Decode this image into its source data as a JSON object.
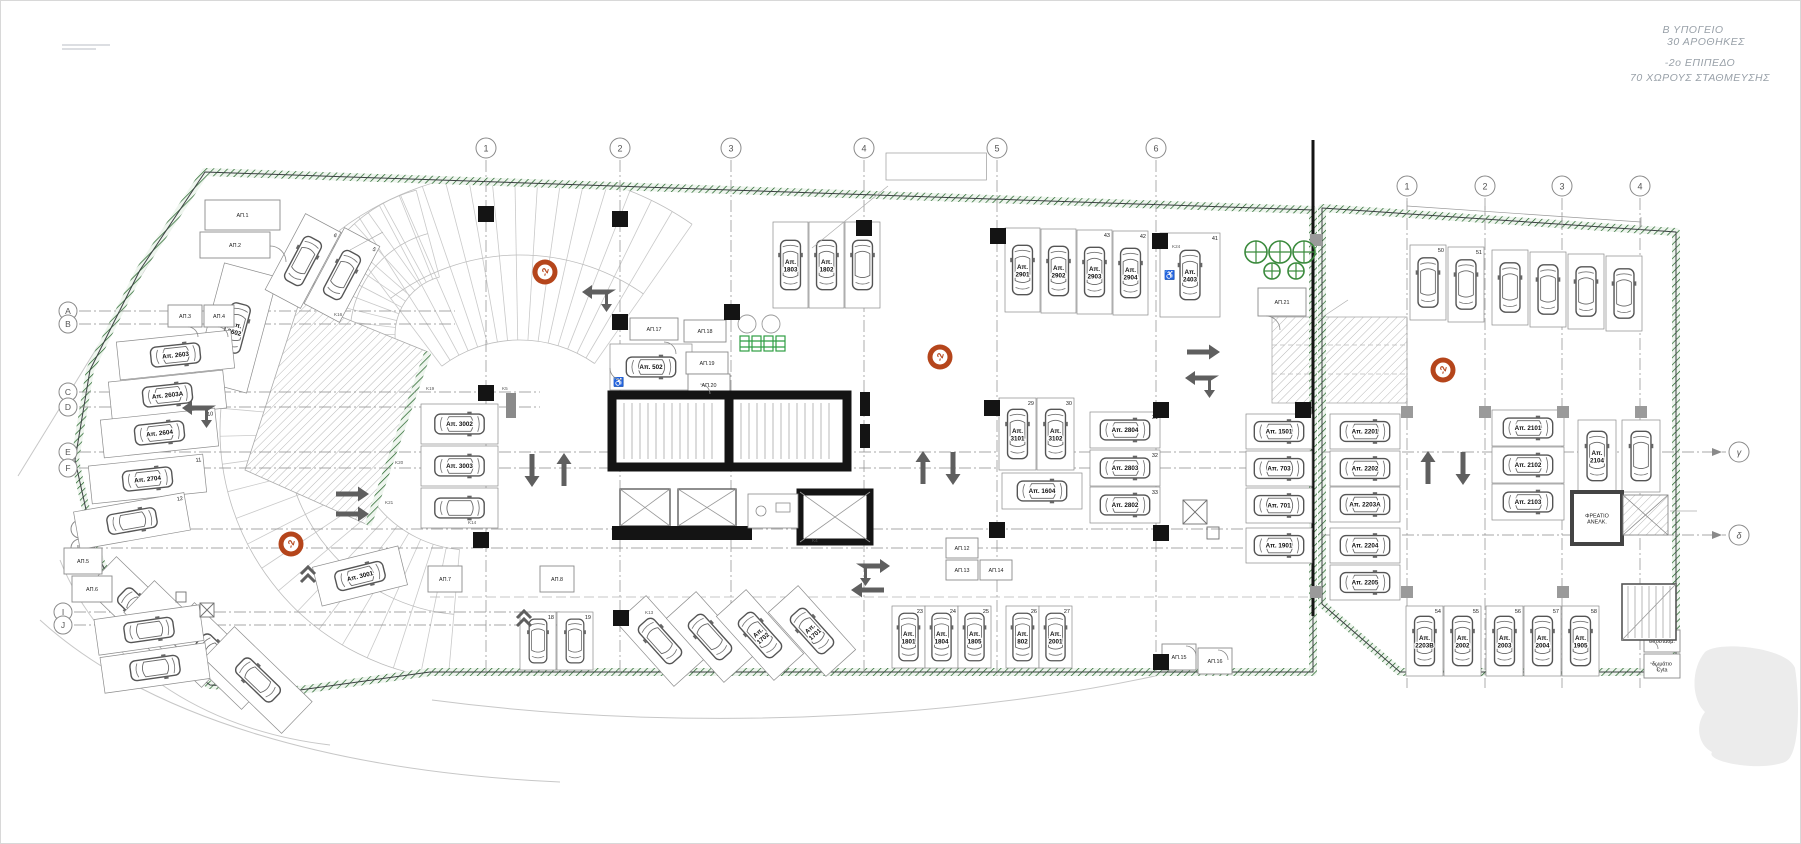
{
  "title_block": {
    "lines": [
      "Β ΥΠΟΓΕΙΟ",
      "30 ΑΡΟΘΗΚΕΣ",
      "-2ο ΕΠΙΠΕΔΟ",
      "70 ΧΩΡΟΥΣ ΣΤΑΘΜΕΥΣΗΣ"
    ]
  },
  "level_badge_label": "-2",
  "colors": {
    "boundary_green": "#2e7d32",
    "badge_orange": "#b5451b",
    "wall_black": "#141414",
    "arrow_gray": "#5f5f5f",
    "annotation_gray": "#9aa1a8",
    "bracket_orange": "#c8802f"
  },
  "grid": {
    "main_cols": [
      {
        "label": "1",
        "x": 486
      },
      {
        "label": "2",
        "x": 620
      },
      {
        "label": "3",
        "x": 731
      },
      {
        "label": "4",
        "x": 864
      },
      {
        "label": "5",
        "x": 997
      },
      {
        "label": "6",
        "x": 1156
      }
    ],
    "annex_cols": [
      {
        "label": "1",
        "x": 1407
      },
      {
        "label": "2",
        "x": 1485
      },
      {
        "label": "3",
        "x": 1562
      },
      {
        "label": "4",
        "x": 1640
      }
    ],
    "rows": [
      {
        "label": "A",
        "bx": 68,
        "y": 311,
        "x2": 455
      },
      {
        "label": "B",
        "bx": 68,
        "y": 324,
        "x2": 455
      },
      {
        "label": "C",
        "bx": 68,
        "y": 392,
        "x2": 540
      },
      {
        "label": "D",
        "bx": 68,
        "y": 407,
        "x2": 540
      },
      {
        "label": "E",
        "bx": 68,
        "y": 452,
        "x2": 1313
      },
      {
        "label": "F",
        "bx": 68,
        "y": 468,
        "x2": 1313
      },
      {
        "label": "G",
        "bx": 80,
        "y": 529,
        "x2": 1313
      },
      {
        "label": "H",
        "bx": 80,
        "y": 548,
        "x2": 1313
      },
      {
        "label": "I",
        "bx": 63,
        "y": 612,
        "x2": 560
      },
      {
        "label": "J",
        "bx": 63,
        "y": 625,
        "x2": 560
      }
    ],
    "annex_rows": [
      {
        "label": "γ",
        "y": 452
      },
      {
        "label": "δ",
        "y": 535
      }
    ]
  },
  "badges": [
    {
      "x": 545,
      "y": 272
    },
    {
      "x": 291,
      "y": 544
    },
    {
      "x": 940,
      "y": 357
    },
    {
      "x": 1443,
      "y": 370
    }
  ],
  "vents": [
    {
      "x": 1256,
      "y": 252,
      "r": 11
    },
    {
      "x": 1280,
      "y": 252,
      "r": 11
    },
    {
      "x": 1304,
      "y": 252,
      "r": 11
    },
    {
      "x": 1272,
      "y": 271,
      "r": 8
    },
    {
      "x": 1296,
      "y": 271,
      "r": 8
    }
  ],
  "stalls": [
    {
      "label": "Απ. 2602",
      "num": "7",
      "x": 208,
      "y": 268,
      "w": 55,
      "h": 120,
      "rot": 15
    },
    {
      "label": "",
      "num": "6",
      "x": 283,
      "y": 218,
      "w": 40,
      "h": 86,
      "rot": 28
    },
    {
      "label": "",
      "num": "5",
      "x": 322,
      "y": 232,
      "w": 40,
      "h": 86,
      "rot": 28
    },
    {
      "label": "Απ. 2603",
      "x": 118,
      "y": 336,
      "w": 115,
      "h": 38,
      "rot": -6
    },
    {
      "label": "Απ. 2603Α",
      "x": 110,
      "y": 376,
      "w": 115,
      "h": 38,
      "rot": -6
    },
    {
      "label": "Απ. 2604",
      "num": "10",
      "x": 102,
      "y": 414,
      "w": 115,
      "h": 38,
      "rot": -6
    },
    {
      "label": "Απ. 2704",
      "num": "11",
      "x": 90,
      "y": 460,
      "w": 115,
      "h": 38,
      "rot": -6
    },
    {
      "label": "",
      "num": "12",
      "x": 76,
      "y": 502,
      "w": 112,
      "h": 38,
      "rot": -10
    },
    {
      "label": "Απ. 301",
      "x": 118,
      "y": 556,
      "w": 44,
      "h": 108,
      "rot": -46
    },
    {
      "label": "Απ. 801",
      "x": 156,
      "y": 580,
      "w": 44,
      "h": 108,
      "rot": -46
    },
    {
      "label": "",
      "x": 196,
      "y": 602,
      "w": 44,
      "h": 108,
      "rot": -46
    },
    {
      "label": "",
      "x": 236,
      "y": 626,
      "w": 44,
      "h": 108,
      "rot": -46
    },
    {
      "label": "",
      "x": 96,
      "y": 612,
      "w": 106,
      "h": 36,
      "rot": -8
    },
    {
      "label": "",
      "x": 102,
      "y": 650,
      "w": 106,
      "h": 36,
      "rot": -8
    },
    {
      "label": "Απ. 3001",
      "x": 316,
      "y": 556,
      "w": 88,
      "h": 40,
      "rot": -14
    },
    {
      "label": "Απ. 3002",
      "x": 421,
      "y": 404,
      "w": 77,
      "h": 40
    },
    {
      "label": "Απ. 3003",
      "x": 421,
      "y": 446,
      "w": 77,
      "h": 40
    },
    {
      "label": "",
      "x": 421,
      "y": 488,
      "w": 77,
      "h": 40
    },
    {
      "label": "Απ. 502",
      "x": 610,
      "y": 344,
      "w": 82,
      "h": 46,
      "dis": true
    },
    {
      "label": "Απ. 1803",
      "x": 773,
      "y": 222,
      "w": 35,
      "h": 86
    },
    {
      "label": "Απ. 1802",
      "x": 809,
      "y": 222,
      "w": 35,
      "h": 86
    },
    {
      "label": "",
      "x": 845,
      "y": 222,
      "w": 35,
      "h": 86
    },
    {
      "label": "Απ. 2901",
      "x": 1005,
      "y": 228,
      "w": 35,
      "h": 84
    },
    {
      "label": "Απ. 2902",
      "x": 1041,
      "y": 229,
      "w": 35,
      "h": 84
    },
    {
      "label": "Απ. 2903",
      "num": "43",
      "x": 1077,
      "y": 230,
      "w": 35,
      "h": 84
    },
    {
      "label": "Απ. 2904",
      "num": "42",
      "x": 1113,
      "y": 231,
      "w": 35,
      "h": 84
    },
    {
      "label": "Απ. 2403",
      "num": "41",
      "x": 1160,
      "y": 233,
      "w": 60,
      "h": 84,
      "dis": true
    },
    {
      "label": "Απ. 3101",
      "num": "29",
      "x": 999,
      "y": 398,
      "w": 37,
      "h": 72
    },
    {
      "label": "Απ. 3102",
      "num": "30",
      "x": 1037,
      "y": 398,
      "w": 37,
      "h": 72
    },
    {
      "label": "Απ. 1604",
      "x": 1002,
      "y": 473,
      "w": 80,
      "h": 36
    },
    {
      "label": "Απ. 2804",
      "num": "31",
      "x": 1090,
      "y": 412,
      "w": 70,
      "h": 36
    },
    {
      "label": "Απ. 2803",
      "num": "32",
      "x": 1090,
      "y": 450,
      "w": 70,
      "h": 36
    },
    {
      "label": "Απ. 2802",
      "num": "33",
      "x": 1090,
      "y": 487,
      "w": 70,
      "h": 36
    },
    {
      "label": "Απ. 1501",
      "x": 1246,
      "y": 414,
      "w": 66,
      "h": 35
    },
    {
      "label": "Απ. 703",
      "x": 1246,
      "y": 451,
      "w": 66,
      "h": 35
    },
    {
      "label": "Απ. 701",
      "x": 1246,
      "y": 488,
      "w": 66,
      "h": 35
    },
    {
      "label": "Απ. 1901",
      "x": 1246,
      "y": 528,
      "w": 66,
      "h": 35
    },
    {
      "label": "",
      "num": "18",
      "x": 520,
      "y": 612,
      "w": 36,
      "h": 58
    },
    {
      "label": "",
      "num": "19",
      "x": 557,
      "y": 612,
      "w": 36,
      "h": 58
    },
    {
      "label": "",
      "x": 640,
      "y": 598,
      "w": 40,
      "h": 86,
      "rot": -42
    },
    {
      "label": "",
      "x": 690,
      "y": 594,
      "w": 40,
      "h": 86,
      "rot": -42
    },
    {
      "label": "Απ. 1702",
      "x": 740,
      "y": 592,
      "w": 40,
      "h": 86,
      "rot": -42
    },
    {
      "label": "Απ. 1701",
      "x": 792,
      "y": 588,
      "w": 40,
      "h": 86,
      "rot": -42
    },
    {
      "label": "Απ. 1801",
      "num": "23",
      "x": 892,
      "y": 606,
      "w": 33,
      "h": 62
    },
    {
      "label": "Απ. 1804",
      "num": "24",
      "x": 925,
      "y": 606,
      "w": 33,
      "h": 62
    },
    {
      "label": "Απ. 1805",
      "num": "25",
      "x": 958,
      "y": 606,
      "w": 33,
      "h": 62
    },
    {
      "label": "Απ. 802",
      "num": "26",
      "x": 1006,
      "y": 606,
      "w": 33,
      "h": 62
    },
    {
      "label": "Απ. 2001",
      "num": "27",
      "x": 1039,
      "y": 606,
      "w": 33,
      "h": 62
    },
    {
      "label": "",
      "num": "50",
      "x": 1410,
      "y": 245,
      "w": 36,
      "h": 75
    },
    {
      "label": "",
      "num": "51",
      "x": 1448,
      "y": 247,
      "w": 36,
      "h": 75
    },
    {
      "label": "",
      "x": 1492,
      "y": 250,
      "w": 36,
      "h": 75
    },
    {
      "label": "",
      "x": 1530,
      "y": 252,
      "w": 36,
      "h": 75
    },
    {
      "label": "",
      "x": 1568,
      "y": 254,
      "w": 36,
      "h": 75
    },
    {
      "label": "",
      "x": 1606,
      "y": 256,
      "w": 36,
      "h": 75
    },
    {
      "label": "Απ. 2201",
      "x": 1330,
      "y": 414,
      "w": 70,
      "h": 35
    },
    {
      "label": "Απ. 2202",
      "x": 1330,
      "y": 451,
      "w": 70,
      "h": 35
    },
    {
      "label": "Απ. 2203Α",
      "x": 1330,
      "y": 487,
      "w": 70,
      "h": 35
    },
    {
      "label": "Απ. 2204",
      "x": 1330,
      "y": 528,
      "w": 70,
      "h": 35
    },
    {
      "label": "Απ. 2205",
      "x": 1330,
      "y": 565,
      "w": 70,
      "h": 35
    },
    {
      "label": "Απ. 2101",
      "x": 1492,
      "y": 410,
      "w": 72,
      "h": 36
    },
    {
      "label": "Απ. 2102",
      "x": 1492,
      "y": 447,
      "w": 72,
      "h": 36
    },
    {
      "label": "Απ. 2103",
      "x": 1492,
      "y": 484,
      "w": 72,
      "h": 36
    },
    {
      "label": "Απ. 2104",
      "x": 1578,
      "y": 420,
      "w": 38,
      "h": 72
    },
    {
      "label": "",
      "x": 1622,
      "y": 420,
      "w": 38,
      "h": 72
    },
    {
      "label": "Απ. 2203Β",
      "num": "54",
      "x": 1406,
      "y": 606,
      "w": 37,
      "h": 70
    },
    {
      "label": "Απ. 2002",
      "num": "55",
      "x": 1444,
      "y": 606,
      "w": 37,
      "h": 70
    },
    {
      "label": "Απ. 2003",
      "num": "56",
      "x": 1486,
      "y": 606,
      "w": 37,
      "h": 70
    },
    {
      "label": "Απ. 2004",
      "num": "57",
      "x": 1524,
      "y": 606,
      "w": 37,
      "h": 70
    },
    {
      "label": "Απ. 1905",
      "num": "58",
      "x": 1562,
      "y": 606,
      "w": 37,
      "h": 70
    }
  ],
  "rooms": [
    {
      "label": "ΑΠ.1",
      "x": 205,
      "y": 200,
      "w": 75,
      "h": 30
    },
    {
      "label": "ΑΠ.2",
      "x": 200,
      "y": 232,
      "w": 70,
      "h": 26
    },
    {
      "label": "ΑΠ.3",
      "x": 168,
      "y": 305,
      "w": 34,
      "h": 22
    },
    {
      "label": "ΑΠ.4",
      "x": 204,
      "y": 305,
      "w": 30,
      "h": 22
    },
    {
      "label": "ΑΠ.5",
      "x": 64,
      "y": 548,
      "w": 38,
      "h": 26
    },
    {
      "label": "ΑΠ.6",
      "x": 72,
      "y": 576,
      "w": 40,
      "h": 26
    },
    {
      "label": "ΑΠ.7",
      "x": 428,
      "y": 566,
      "w": 34,
      "h": 26
    },
    {
      "label": "ΑΠ.8",
      "x": 540,
      "y": 566,
      "w": 34,
      "h": 26
    },
    {
      "label": "ΑΠ.12",
      "x": 946,
      "y": 538,
      "w": 32,
      "h": 20
    },
    {
      "label": "ΑΠ.13",
      "x": 946,
      "y": 560,
      "w": 32,
      "h": 20
    },
    {
      "label": "ΑΠ.14",
      "x": 980,
      "y": 560,
      "w": 32,
      "h": 20
    },
    {
      "label": "ΑΠ.15",
      "x": 1162,
      "y": 644,
      "w": 34,
      "h": 26
    },
    {
      "label": "ΑΠ.16",
      "x": 1198,
      "y": 648,
      "w": 34,
      "h": 26
    },
    {
      "label": "ΑΠ.17",
      "x": 630,
      "y": 318,
      "w": 48,
      "h": 22
    },
    {
      "label": "ΑΠ.18",
      "x": 684,
      "y": 320,
      "w": 42,
      "h": 22
    },
    {
      "label": "ΑΠ.19",
      "x": 686,
      "y": 352,
      "w": 42,
      "h": 22
    },
    {
      "label": "ΑΠ.20",
      "x": 688,
      "y": 374,
      "w": 42,
      "h": 22
    },
    {
      "label": "ΑΠ.21",
      "x": 1258,
      "y": 288,
      "w": 48,
      "h": 28
    },
    {
      "label": "ΦΡΕΑΤΙΟ ΑΝΕΛΚ.",
      "x": 1572,
      "y": 492,
      "w": 50,
      "h": 52,
      "thick": true
    },
    {
      "label": "υποσταθμ.",
      "x": 1644,
      "y": 630,
      "w": 36,
      "h": 22
    },
    {
      "label": "δωμάτιο Cyta",
      "x": 1644,
      "y": 654,
      "w": 36,
      "h": 24
    }
  ],
  "arrows": [
    {
      "x": 600,
      "y": 292,
      "d": "fork-left"
    },
    {
      "x": 200,
      "y": 408,
      "d": "fork-left"
    },
    {
      "x": 352,
      "y": 494,
      "d": "right"
    },
    {
      "x": 352,
      "y": 514,
      "d": "right"
    },
    {
      "x": 532,
      "y": 470,
      "d": "down"
    },
    {
      "x": 564,
      "y": 470,
      "d": "up"
    },
    {
      "x": 923,
      "y": 468,
      "d": "up"
    },
    {
      "x": 953,
      "y": 468,
      "d": "down"
    },
    {
      "x": 1203,
      "y": 352,
      "d": "right"
    },
    {
      "x": 1203,
      "y": 378,
      "d": "fork-left"
    },
    {
      "x": 872,
      "y": 566,
      "d": "fork-right"
    },
    {
      "x": 868,
      "y": 590,
      "d": "left"
    },
    {
      "x": 1428,
      "y": 468,
      "d": "up"
    },
    {
      "x": 1463,
      "y": 468,
      "d": "down"
    },
    {
      "x": 524,
      "y": 614,
      "d": "chev-up"
    },
    {
      "x": 308,
      "y": 570,
      "d": "chev-up"
    }
  ],
  "notes": [
    {
      "x": 890,
      "y": 160,
      "lines": [
        "ΚΑΘΕΤΟΣ ΑΓΩΓΟΣ ΠΑΡΟΧΩΝ",
        "ΤΗΛΕΠΙΚΟΙΝΩΝΙΩΝ 600mm x 200mm ΚΑΙ",
        "ΣΥΣΤΗΜΑΤΩΝ 1600mmx200mm"
      ],
      "size": 5,
      "align": "start",
      "boxed": true,
      "color": "#8d959c"
    },
    {
      "x": 770,
      "y": 96,
      "lines": [
        "ΕΞΑΕΡΙΣΤΗΡΕΣ ΚΛΙΜΑΚΙΩΝ ΚΑΙ ΚΩΛΩΝ",
        "ΠΥΡΚΑΓΙΑΣ ΑΞΟΝΙΚΟΥ ΤΥΠΟΥ"
      ],
      "size": 4.5,
      "align": "end",
      "color": "#9aa1a8"
    },
    {
      "x": 770,
      "y": 117,
      "lines": [
        "ΘΕΣΗ ΑΕΡΑΓΩΓΟΥ ΕΞΑΕΡΙΣΜΟΥ",
        "ΠΡΟΣ ΤΑ ΠΑΝΩ"
      ],
      "size": 4.5,
      "align": "end",
      "color": "#9aa1a8"
    },
    {
      "x": 1408,
      "y": 264,
      "lines": [
        "ΘΕΣΗ ΑΕΡΑΓΩΓΟΥ ΕΞΑΕΡΙΣΜΟΥ",
        "ΠΡΟΣ ΤΑ ΠΑΝΩ"
      ],
      "size": 4.5,
      "align": "end",
      "color": "#9aa1a8"
    },
    {
      "x": 1408,
      "y": 287,
      "lines": [
        "ΕΞΑΕΡΙΣΤΗΡΕΣ ΚΛΙΜΑΚΙΩΝ ΚΑΙ ΚΩΛΩΝ",
        "ΠΥΡΚΑΓΙΑΣ ΑΞΟΝΙΚΟΥ ΤΥΠΟΥ"
      ],
      "size": 4.5,
      "align": "end",
      "color": "#9aa1a8"
    },
    {
      "x": 1370,
      "y": 364,
      "lines": [
        "ράμπα κλίση 14%"
      ],
      "size": 7.5,
      "align": "middle",
      "color": "#9aa1a8"
    },
    {
      "x": 1182,
      "y": 594,
      "lines": [
        "ΤΟ ΥΨΟΣ  ΣΕ ΑΥΤΗ ΤΗΝ",
        "ΠΕΡΙΟΧΗ ΕΙΝΑΙ 1,65"
      ],
      "size": 9,
      "align": "start",
      "color": "#9aa1a8"
    },
    {
      "x": 385,
      "y": 231,
      "lines": [
        "fireshutter"
      ],
      "size": 7,
      "align": "start",
      "color": "#9aa1a8"
    },
    {
      "x": 230,
      "y": 524,
      "lines": [
        "R4.26"
      ],
      "size": 7.5,
      "align": "middle",
      "color": "#555555",
      "rot": -48
    },
    {
      "x": 1446,
      "y": 492,
      "lines": [
        "ΣΤ. ΜΠ. -6.10"
      ],
      "size": 5,
      "align": "start",
      "color": "#8d959c"
    },
    {
      "x": 1462,
      "y": 508,
      "lines": [
        "-6.05"
      ],
      "size": 5,
      "align": "start",
      "color": "#8d959c"
    },
    {
      "x": 1697,
      "y": 513,
      "lines": [
        "εξαερισμός σε οροφή υπογείου 7,84τμ"
      ],
      "size": 4.5,
      "align": "start",
      "color": "#8d959c"
    }
  ],
  "elevations": [
    {
      "x": 252,
      "y": 503,
      "top": "-5.65",
      "bottom": "-5.70"
    },
    {
      "x": 486,
      "y": 583,
      "top": "-6.05",
      "bottom": "-6.10"
    },
    {
      "x": 378,
      "y": 331,
      "top": "-7.25",
      "bottom": ""
    }
  ],
  "k_labels": [
    {
      "t": "K4",
      "x": 812,
      "y": 542
    },
    {
      "t": "K5",
      "x": 502,
      "y": 390
    },
    {
      "t": "K13",
      "x": 645,
      "y": 614
    },
    {
      "t": "K14",
      "x": 468,
      "y": 524
    },
    {
      "t": "K16",
      "x": 334,
      "y": 316
    },
    {
      "t": "K19",
      "x": 426,
      "y": 390
    },
    {
      "t": "K20",
      "x": 395,
      "y": 464
    },
    {
      "t": "K21",
      "x": 385,
      "y": 504
    },
    {
      "t": "K24",
      "x": 1172,
      "y": 248
    }
  ],
  "columns": {
    "black": [
      [
        486,
        214
      ],
      [
        620,
        219
      ],
      [
        864,
        228
      ],
      [
        998,
        236
      ],
      [
        1160,
        241
      ],
      [
        486,
        393
      ],
      [
        620,
        322
      ],
      [
        732,
        312
      ],
      [
        992,
        408
      ],
      [
        1161,
        410
      ],
      [
        1303,
        410
      ],
      [
        481,
        540
      ],
      [
        621,
        618
      ],
      [
        997,
        530
      ],
      [
        1161,
        533
      ],
      [
        1161,
        662
      ]
    ],
    "gray": [
      [
        1407,
        412
      ],
      [
        1485,
        412
      ],
      [
        1563,
        412
      ],
      [
        1641,
        412
      ],
      [
        1407,
        592
      ],
      [
        1563,
        592
      ],
      [
        1316,
        240
      ],
      [
        1316,
        592
      ]
    ],
    "small": [
      [
        865,
        404
      ],
      [
        865,
        436
      ]
    ]
  },
  "section_markers": [
    {
      "x": 742,
      "y": 190,
      "label": "B"
    },
    {
      "x": 663,
      "y": 706,
      "label": "B"
    }
  ],
  "brackets": [
    {
      "x1": 532,
      "x2": 850,
      "y": 703
    },
    {
      "x1": 866,
      "x2": 1143,
      "y": 701
    }
  ]
}
